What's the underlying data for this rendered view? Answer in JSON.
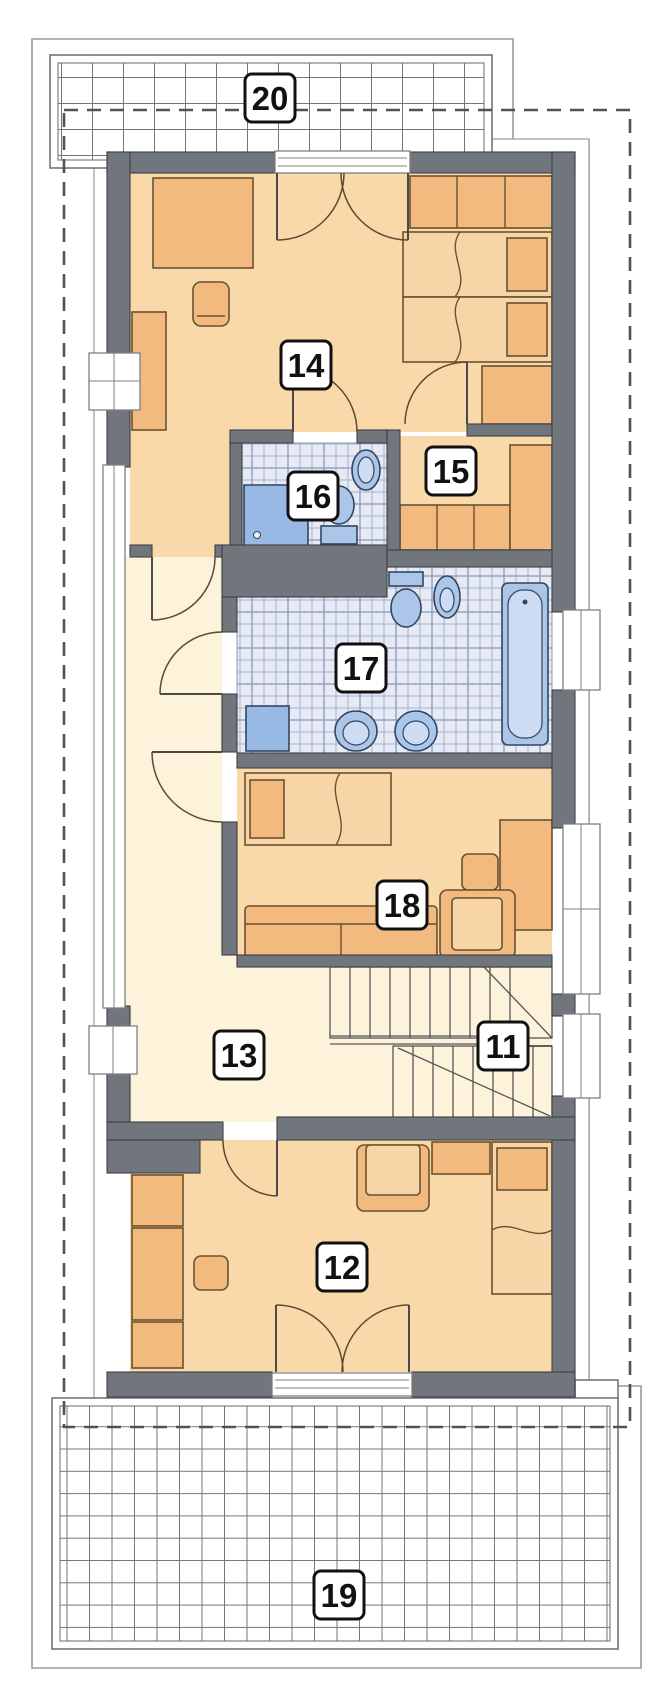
{
  "labels": {
    "r11": "11",
    "r12": "12",
    "r13": "13",
    "r14": "14",
    "r15": "15",
    "r16": "16",
    "r17": "17",
    "r18": "18",
    "r19": "19",
    "r20": "20"
  },
  "colors": {
    "wall": "#71757c",
    "wallStroke": "#3c4047",
    "floorWarm": "#f9d9a9",
    "floorCream": "#fdf2da",
    "furn": "#f2ba7e",
    "furnLight": "#f7d5a6",
    "furnStroke": "#6b5130",
    "tileBase": "#e6eaf4",
    "tileLine": "#aab3cf",
    "tileLineStrong": "#8d98ba",
    "fix": "#abc6e8",
    "fixLight": "#cddcf2",
    "fixDark": "#97b9e4",
    "fixStroke": "#32455f",
    "gridLine": "#767676",
    "outline": "#9a9a9a",
    "dash": "#4f5358",
    "labelBg": "#ffffff",
    "labelBorder": "#111111",
    "labelText": "#111111"
  }
}
